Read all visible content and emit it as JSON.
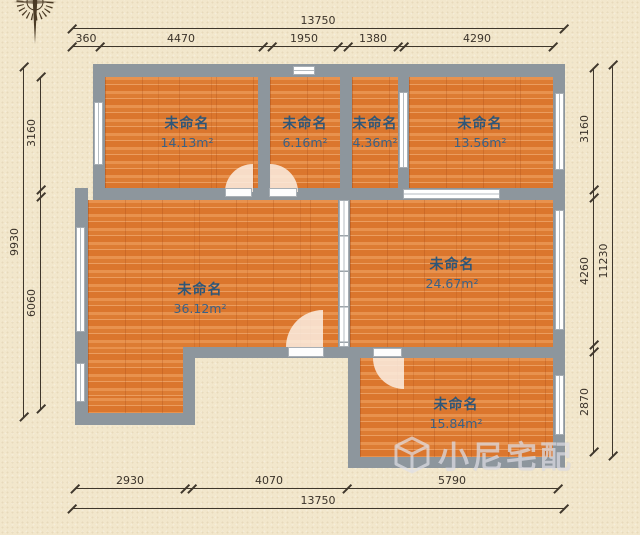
{
  "colors": {
    "wall": "#8d969d",
    "floor": "#e0823d",
    "background": "#f2e7cc",
    "room_text": "#2e5678",
    "dim_text": "#3b332a",
    "watermark": "#d9dadf"
  },
  "rooms": [
    {
      "name": "未命名",
      "area": "14.13m²"
    },
    {
      "name": "未命名",
      "area": "6.16m²"
    },
    {
      "name": "未命名",
      "area": "4.36m²"
    },
    {
      "name": "未命名",
      "area": "13.56m²"
    },
    {
      "name": "未命名",
      "area": "36.12m²"
    },
    {
      "name": "未命名",
      "area": "24.67m²"
    },
    {
      "name": "未命名",
      "area": "15.84m²"
    }
  ],
  "dimensions": {
    "top_total": "13750",
    "top": [
      "360",
      "4470",
      "1950",
      "1380",
      "4290"
    ],
    "left_total": "9930",
    "left": [
      "3160",
      "6060"
    ],
    "right_total": "11230",
    "right": [
      "3160",
      "4260",
      "2870"
    ],
    "bottom": [
      "2930",
      "4070",
      "5790"
    ],
    "bottom_total": "13750"
  },
  "watermark": {
    "text": "小尼宅配"
  }
}
